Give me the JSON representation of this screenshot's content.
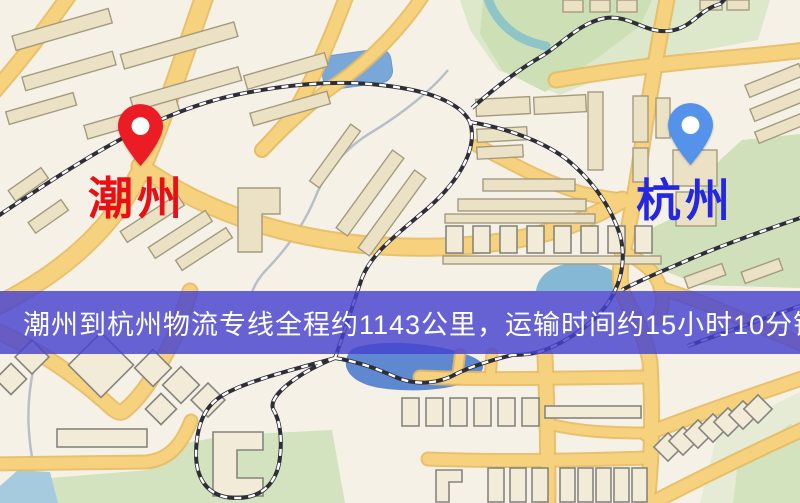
{
  "banner": {
    "text": "潮州到杭州物流专线全程约1143公里，运输时间约15小时10分钟.",
    "background": "rgba(70,66,208,0.82)",
    "text_color": "#ffffff"
  },
  "pins": {
    "origin": {
      "label": "潮州",
      "label_color": "#e90f15",
      "pin_color": "#ec1c24",
      "dot_color": "#ffffff"
    },
    "destination": {
      "label": "杭州",
      "label_color": "#2526df",
      "pin_color": "#5592ea",
      "dot_color": "#ffffff"
    }
  },
  "css_colors": {
    "origin-label": "#e90f15",
    "destination-label": "#2526df",
    "banner-bg": "rgba(70,66,208,0.82)",
    "banner-text": "#ffffff",
    "map-bg": "#f6f1e7",
    "road-yellow": "#f6d27f",
    "park-green": "#cddfb5",
    "water-blue": "#79a8d8"
  }
}
